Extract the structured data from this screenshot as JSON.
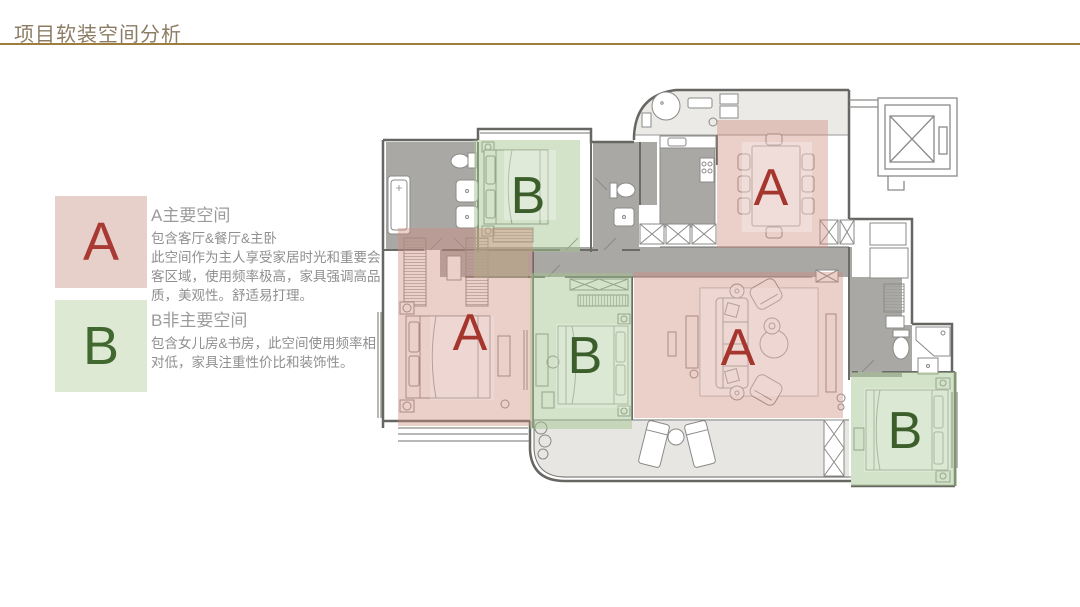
{
  "slide": {
    "title": "项目软装空间分析",
    "title_color": "#8c7c63",
    "rule_color": "#9e7e3e"
  },
  "legend": {
    "items": [
      {
        "letter": "A",
        "heading": "A主要空间",
        "subheading": "包含客厅&餐厅&主卧",
        "body": "此空间作为主人享受家居时光和重要会客区域，使用频率极高，家具强调高品质，美观性。舒适易打理。",
        "swatch_color": "#e7cfca",
        "letter_color": "#a83a33"
      },
      {
        "letter": "B",
        "heading": "B非主要空间",
        "subheading": "",
        "body": "包含女儿房&书房，此空间使用频率相对低，家具注重性价比和装饰性。",
        "swatch_color": "#dde9d2",
        "letter_color": "#40682f"
      }
    ]
  },
  "floorplan": {
    "zones": [
      {
        "id": "bedroom-top",
        "label": "B",
        "type": "secondary"
      },
      {
        "id": "dining-room",
        "label": "A",
        "type": "primary"
      },
      {
        "id": "master-bedroom",
        "label": "A",
        "type": "primary"
      },
      {
        "id": "bedroom-middle",
        "label": "B",
        "type": "secondary"
      },
      {
        "id": "living-room",
        "label": "A",
        "type": "primary"
      },
      {
        "id": "bedroom-bottom",
        "label": "B",
        "type": "secondary"
      }
    ],
    "zone_colors": {
      "primary_fill": "#cf8d7f",
      "primary_letter": "#a5362e",
      "secondary_fill": "#a3c48e",
      "secondary_letter": "#3b5e2a"
    }
  }
}
